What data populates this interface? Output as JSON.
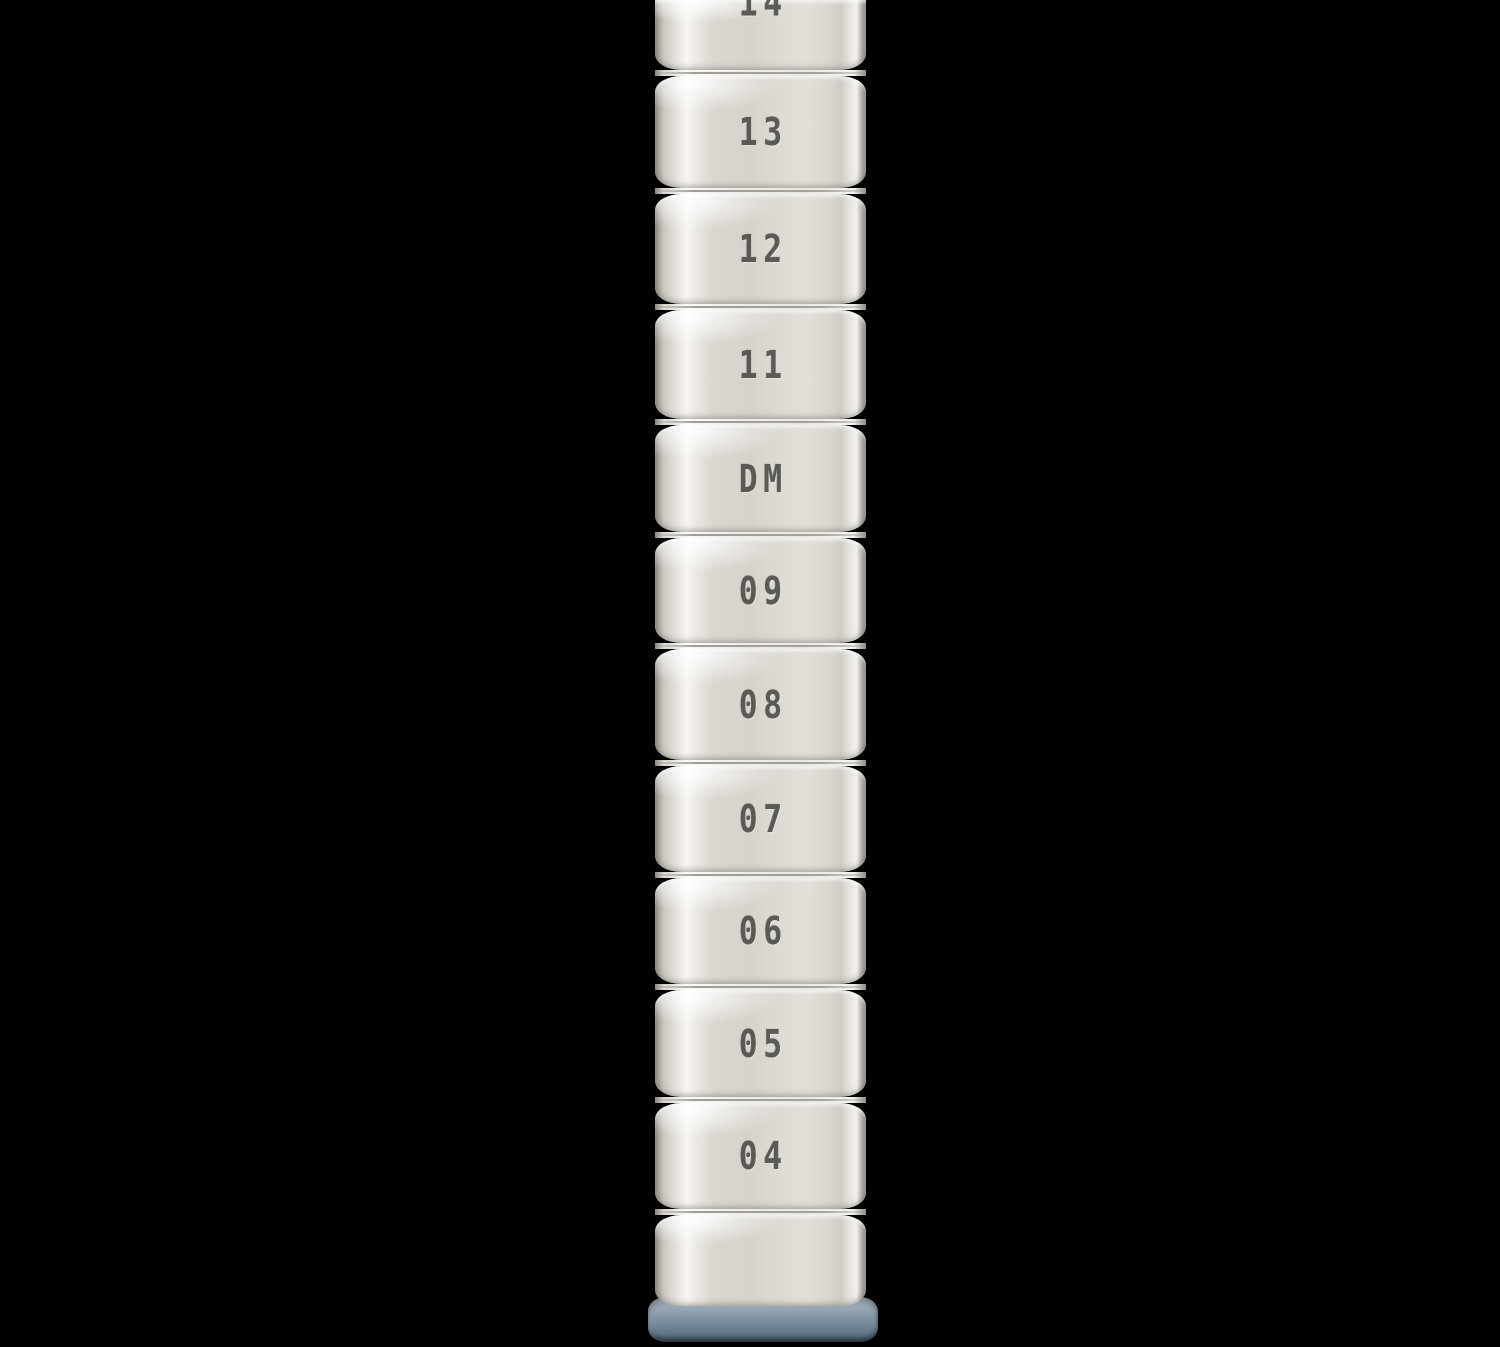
{
  "photo": {
    "subject": "shelving-post",
    "background_color": "#000000",
    "post": {
      "body_color": "#dcd8d1",
      "highlight_color": "#f6f5f3",
      "edge_color": "#7d7972",
      "stamp_color": "#4b4944",
      "sections": [
        {
          "label": "14"
        },
        {
          "label": "13"
        },
        {
          "label": "12"
        },
        {
          "label": "11"
        },
        {
          "label": "DM"
        },
        {
          "label": "09"
        },
        {
          "label": "08"
        },
        {
          "label": "07"
        },
        {
          "label": "06"
        },
        {
          "label": "05"
        },
        {
          "label": "04"
        },
        {
          "label": ""
        }
      ]
    },
    "foot_cap": {
      "color": "#7e92a2"
    }
  }
}
